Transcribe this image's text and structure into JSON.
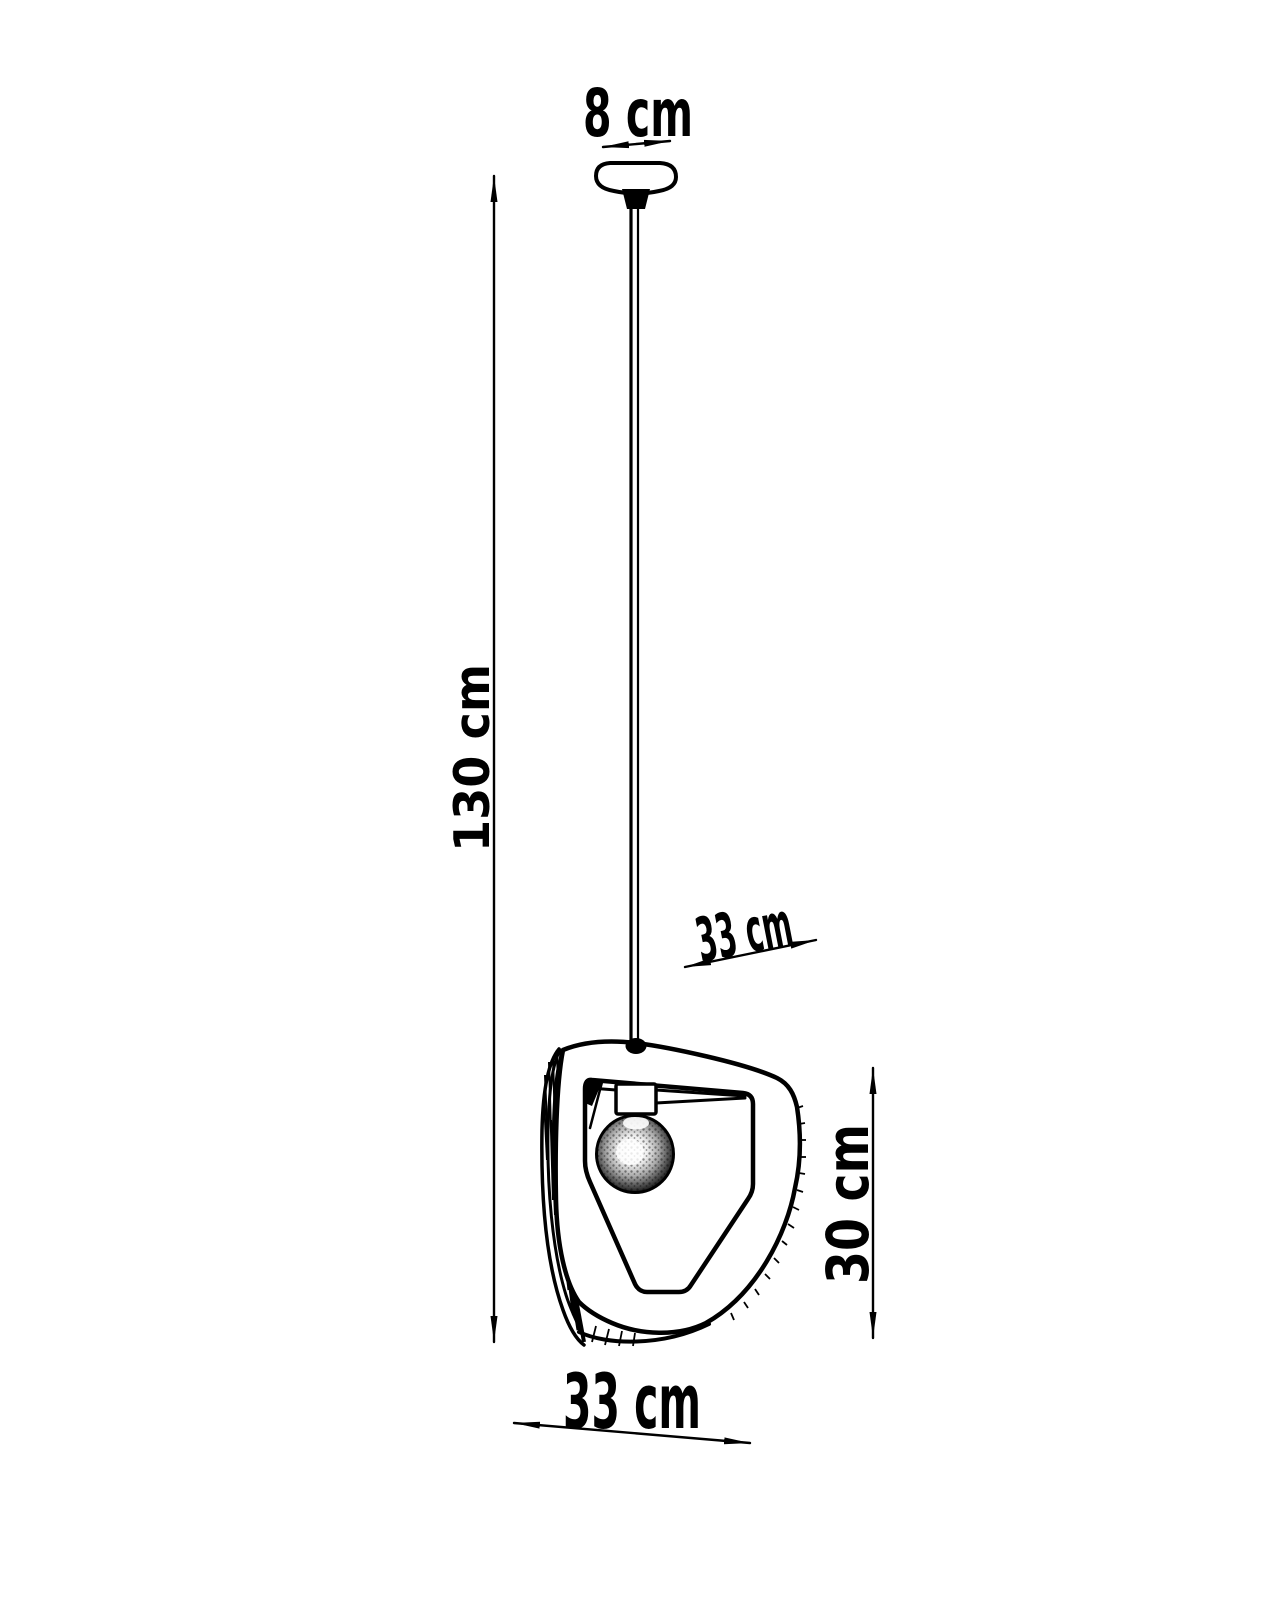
{
  "page": {
    "background_color": "#ffffff",
    "line_color": "#000000"
  },
  "diagram": {
    "type": "pendant-lamp-dimension-drawing",
    "dimensions": {
      "canopy_width": {
        "label": "8 cm"
      },
      "drop_height": {
        "label": "130 cm"
      },
      "shade_depth": {
        "label": "33 cm"
      },
      "shade_height": {
        "label": "30 cm"
      },
      "shade_width": {
        "label": "33 cm"
      }
    }
  }
}
